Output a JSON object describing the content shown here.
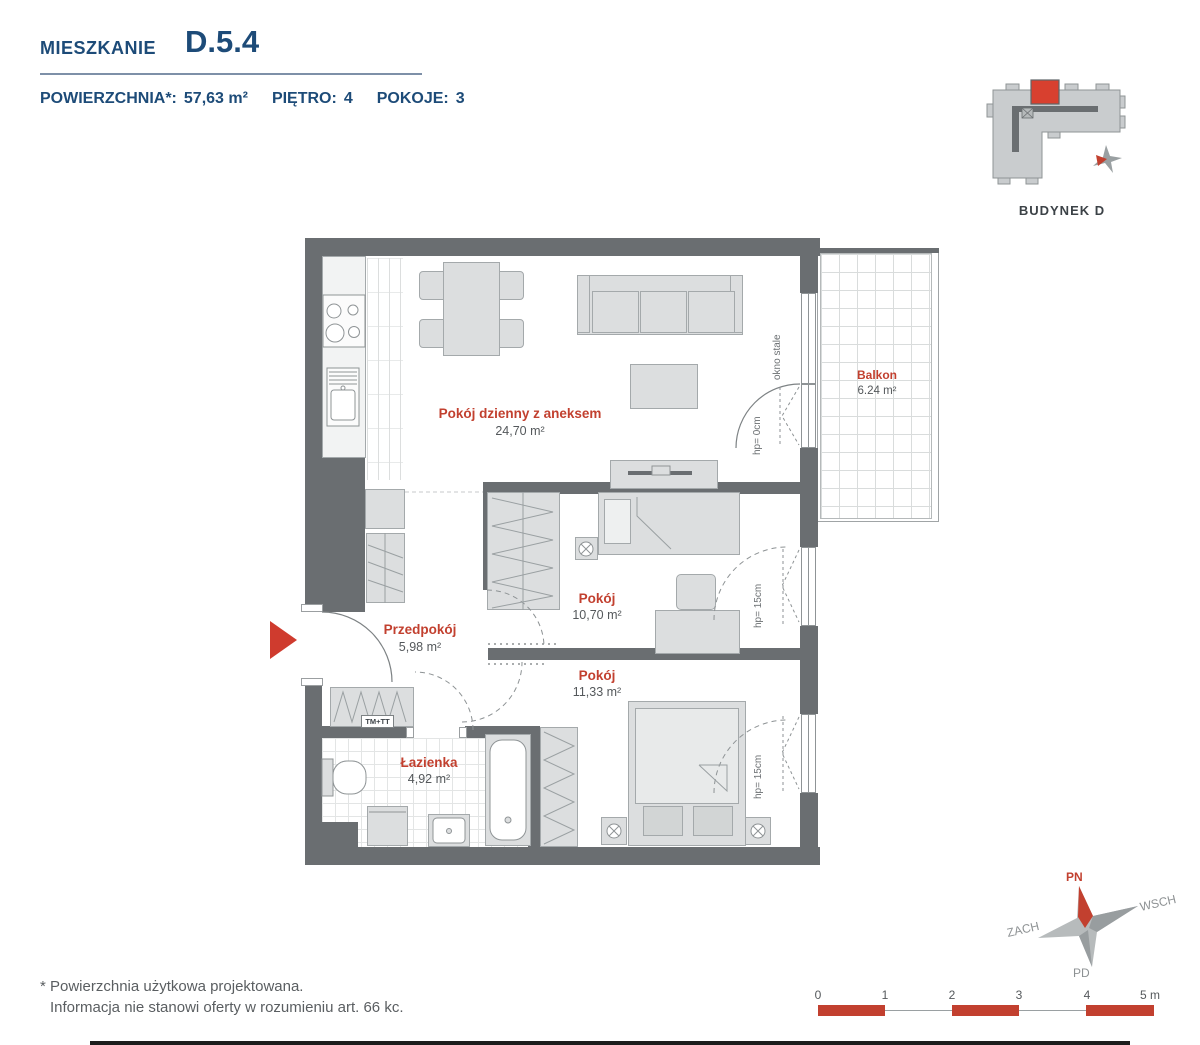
{
  "header": {
    "label": "MIESZKANIE",
    "unit": "D.5.4",
    "area_label": "POWIERZCHNIA*:",
    "area_value": "57,63 m²",
    "floor_label": "PIĘTRO:",
    "floor_value": "4",
    "rooms_label": "POKOJE:",
    "rooms_value": "3"
  },
  "building_inset": {
    "name": "BUDYNEK",
    "letter": "D"
  },
  "rooms": {
    "living": {
      "name": "Pokój dzienny z aneksem",
      "area": "24,70 m²"
    },
    "balcony": {
      "name": "Balkon",
      "area": "6.24 m²"
    },
    "room1": {
      "name": "Pokój",
      "area": "10,70 m²"
    },
    "room2": {
      "name": "Pokój",
      "area": "11,33 m²"
    },
    "hall": {
      "name": "Przedpokój",
      "area": "5,98 m²"
    },
    "bath": {
      "name": "Łazienka",
      "area": "4,92 m²"
    }
  },
  "annotations": {
    "fixed_window": "okno stale",
    "door_height": "hp= 0cm",
    "window_height": "hp= 15cm",
    "wardrobe": "TM+TT"
  },
  "compass": {
    "north": "PN",
    "east": "WSCH",
    "south": "PD",
    "west": "ZACH"
  },
  "scale_bar": {
    "ticks": [
      "0",
      "1",
      "2",
      "3",
      "4",
      "5 m"
    ]
  },
  "footnote": {
    "line1": "* Powierzchnia użytkowa projektowana.",
    "line2": "Informacja nie stanowi oferty w rozumieniu art. 66 kc."
  },
  "colors": {
    "navy": "#1d4b78",
    "label_red": "#c2402f",
    "accent_red": "#cf3b2e",
    "wall_gray": "#6a6e71",
    "furniture_gray": "#dcdedf",
    "area_text": "#54585b"
  }
}
